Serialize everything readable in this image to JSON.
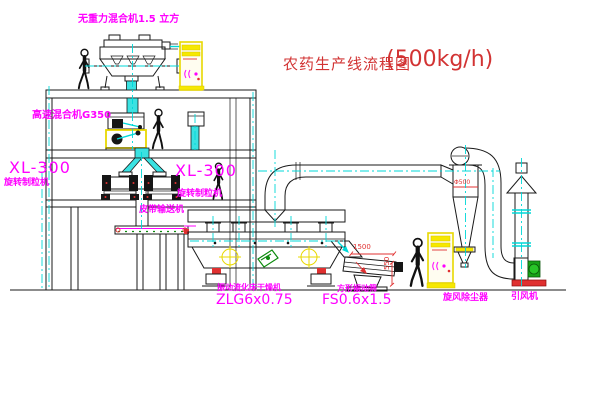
{
  "title": {
    "name": "农药生产线流程图",
    "capacity": "(500kg/h)"
  },
  "equipment_labels": {
    "gravity_free_mixer": "无重力混合机1.5 立方",
    "high_speed_mixer": "高速混合机G350",
    "granulator_left_model": "XL-300",
    "granulator_left_name": "旋转制粒机",
    "granulator_right_model": "XL-300",
    "granulator_right_name": "旋转制粒机",
    "belt_conveyor": "皮带输送机",
    "fluid_bed_dryer_name": "振动流化床干燥机",
    "fluid_bed_dryer_model": "ZLG6x0.75",
    "vibrating_screen_name": "方形振动筛",
    "vibrating_screen_model": "FS0.6x1.5",
    "cyclone_dust_collector": "旋风除尘器",
    "induced_draft_fan": "引风机"
  },
  "dimensions": {
    "screen_length": "1500",
    "screen_height": "550",
    "cyclone_diameter": "Φ500"
  },
  "colors": {
    "label_magenta": "#ff00ff",
    "title_red": "#d23333",
    "centerline_cyan": "#00d8d8",
    "highlight_yellow": "#f6e800",
    "line_black": "#1a1a1a"
  }
}
